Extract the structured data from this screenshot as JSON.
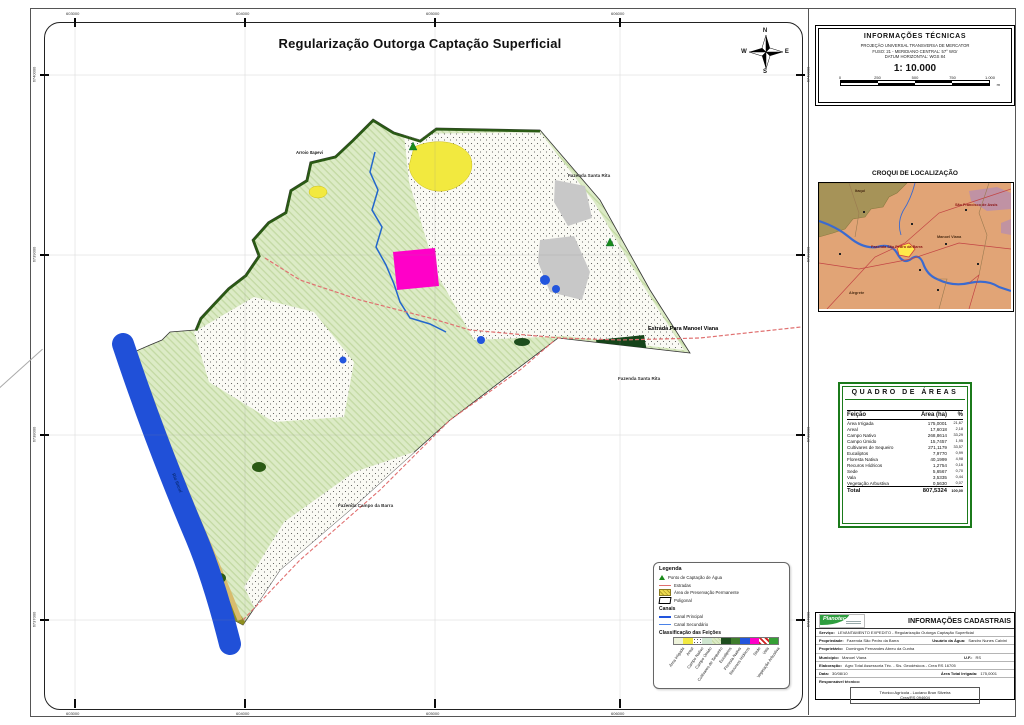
{
  "page_title": "Regularização Outorga Captação Superficial",
  "compass": {
    "n": "N",
    "e": "E",
    "s": "S",
    "w": "W"
  },
  "frame_coords": {
    "top": [
      "603000",
      "604000",
      "605000",
      "606000"
    ],
    "bottom": [
      "603000",
      "604000",
      "605000",
      "606000"
    ],
    "left": [
      "6740000",
      "6739000",
      "6738000",
      "6737000"
    ],
    "right": [
      "6740000",
      "6739000",
      "6738000",
      "6737000"
    ]
  },
  "map_labels": {
    "arroio": "Arroio Itapevi",
    "fazenda_santa_rita_1": "Fazenda Santa Rita",
    "fazenda_santa_rita_2": "Fazenda Santa Rita",
    "fazenda_campo_barra": "Fazenda Campo da Barra",
    "estrada": "Estrada Para Manoel Viana",
    "rio": "Rio Ibicuí"
  },
  "legend": {
    "title": "Legenda",
    "items": [
      {
        "label": "Ponto de Captação de Água"
      },
      {
        "label": "Estradas"
      },
      {
        "label": "Área de Preservação Permanente"
      },
      {
        "label": "Poligonal"
      }
    ],
    "canais_title": "Canais",
    "canais": [
      {
        "label": "Canal Principal"
      },
      {
        "label": "Canal Secundário"
      }
    ],
    "classificacao_title": "Classificação das Feições",
    "classes": [
      {
        "label": "Área Irrigada",
        "css": "#eef3da"
      },
      {
        "label": "Areal",
        "css": "#f2e93f"
      },
      {
        "label": "Campo Nativo",
        "css": "radial-gradient(#555 22%, transparent 24%) 0 0 / 3px 3px #fff"
      },
      {
        "label": "Campo Úmido",
        "css": "#cfe6cf"
      },
      {
        "label": "Cultivares de Sequeiro",
        "css": "repeating-linear-gradient(45deg,#dcebc6 0 2px,#c3d9a3 2px 3px)"
      },
      {
        "label": "Eucaliptos",
        "css": "#1d4d1d"
      },
      {
        "label": "Floresta Nativa",
        "css": "#3f7d2c"
      },
      {
        "label": "Recursos Hídricos",
        "css": "#2255dd"
      },
      {
        "label": "Sede",
        "css": "#ff00c8"
      },
      {
        "label": "Vala",
        "css": "repeating-linear-gradient(45deg,#d22222 0 2px,#fff 2px 4px)"
      },
      {
        "label": "Vegetação Arbustiva",
        "css": "#35a035"
      }
    ]
  },
  "tech_info": {
    "title": "INFORMAÇÕES TÉCNICAS",
    "line1": "PROJEÇÃO UNIVERSAL TRANSVERSA DE MERCATOR",
    "line2": "FUSO: 21 - MERIDIANO CENTRAL: 57° WGr",
    "line3": "DATUM HORIZONTAL: WGS 84",
    "scale": "1: 10.000",
    "scalebar_labels": [
      "0",
      "250",
      "500",
      "750",
      "1.000"
    ],
    "scalebar_unit": "m"
  },
  "croqui": {
    "title": "CROQUI DE LOCALIZAÇÃO",
    "labels": {
      "itaqui": "Itaqui",
      "sao_francisco": "São Francisco de Assis",
      "manoel_viana": "Manoel Viana",
      "fazenda": "Fazenda São Pedro da Barra",
      "alegrete": "Alegrete"
    }
  },
  "areas_table": {
    "title": "QUADRO DE ÁREAS",
    "headers": [
      "Feição",
      "Área (ha)",
      "%"
    ],
    "rows": [
      {
        "f": "Área Irrigada",
        "a": "175,0001",
        "p": "21,67"
      },
      {
        "f": "Areal",
        "a": "17,6018",
        "p": "2,18"
      },
      {
        "f": "Campo Nativo",
        "a": "268,8614",
        "p": "33,29"
      },
      {
        "f": "Campo Úmido",
        "a": "15,7457",
        "p": "1,95"
      },
      {
        "f": "Cultivares de Sequeiro",
        "a": "271,1179",
        "p": "33,57"
      },
      {
        "f": "Eucaliptos",
        "a": "7,9770",
        "p": "0,99"
      },
      {
        "f": "Floresta Nativa",
        "a": "40,1999",
        "p": "4,98"
      },
      {
        "f": "Recuros Hídricos",
        "a": "1,2754",
        "p": "0,16"
      },
      {
        "f": "Sede",
        "a": "5,6567",
        "p": "0,70"
      },
      {
        "f": "Vala",
        "a": "3,5335",
        "p": "0,44"
      },
      {
        "f": "Vegetação Arbustiva",
        "a": "0,5630",
        "p": "0,07"
      }
    ],
    "total": {
      "f": "Total",
      "a": "807,5324",
      "p": "100,00"
    }
  },
  "cadastral": {
    "title": "INFORMAÇÕES CADASTRAIS",
    "logo_name": "Planotec",
    "servico_label": "Serviço:",
    "servico": "LEVANTAMENTO EXPEDITO - Regularização Outorga Captação Superficial",
    "propriedade_label": "Propriedade:",
    "propriedade": "Fazenda São Pedro da Barra",
    "usuario_label": "Usuário da Água:",
    "usuario": "Sandro Nunes Calvini",
    "proprietario_label": "Proprietário:",
    "proprietario": "Domingos Fernandes Abreu da Cunha",
    "municipio_label": "Município:",
    "municipio": "Manoel Viana",
    "uf_label": "U.F.:",
    "uf": "RS",
    "elaboracao_label": "Elaboração:",
    "elaboracao": "Agro Total Assessoria Téc. - Sis. Geodésicos - Crea RS 16705",
    "data_label": "Data:",
    "data": "30/08/10",
    "area_irrigada_label": "Área Total Irrigada:",
    "area_irrigada": "175,0001",
    "responsavel_label": "Responsável técnico:",
    "footer_line1": "Técnico Agrícola - Luciano Brun Silveira",
    "footer_line2": "Crea/RS 094604"
  }
}
